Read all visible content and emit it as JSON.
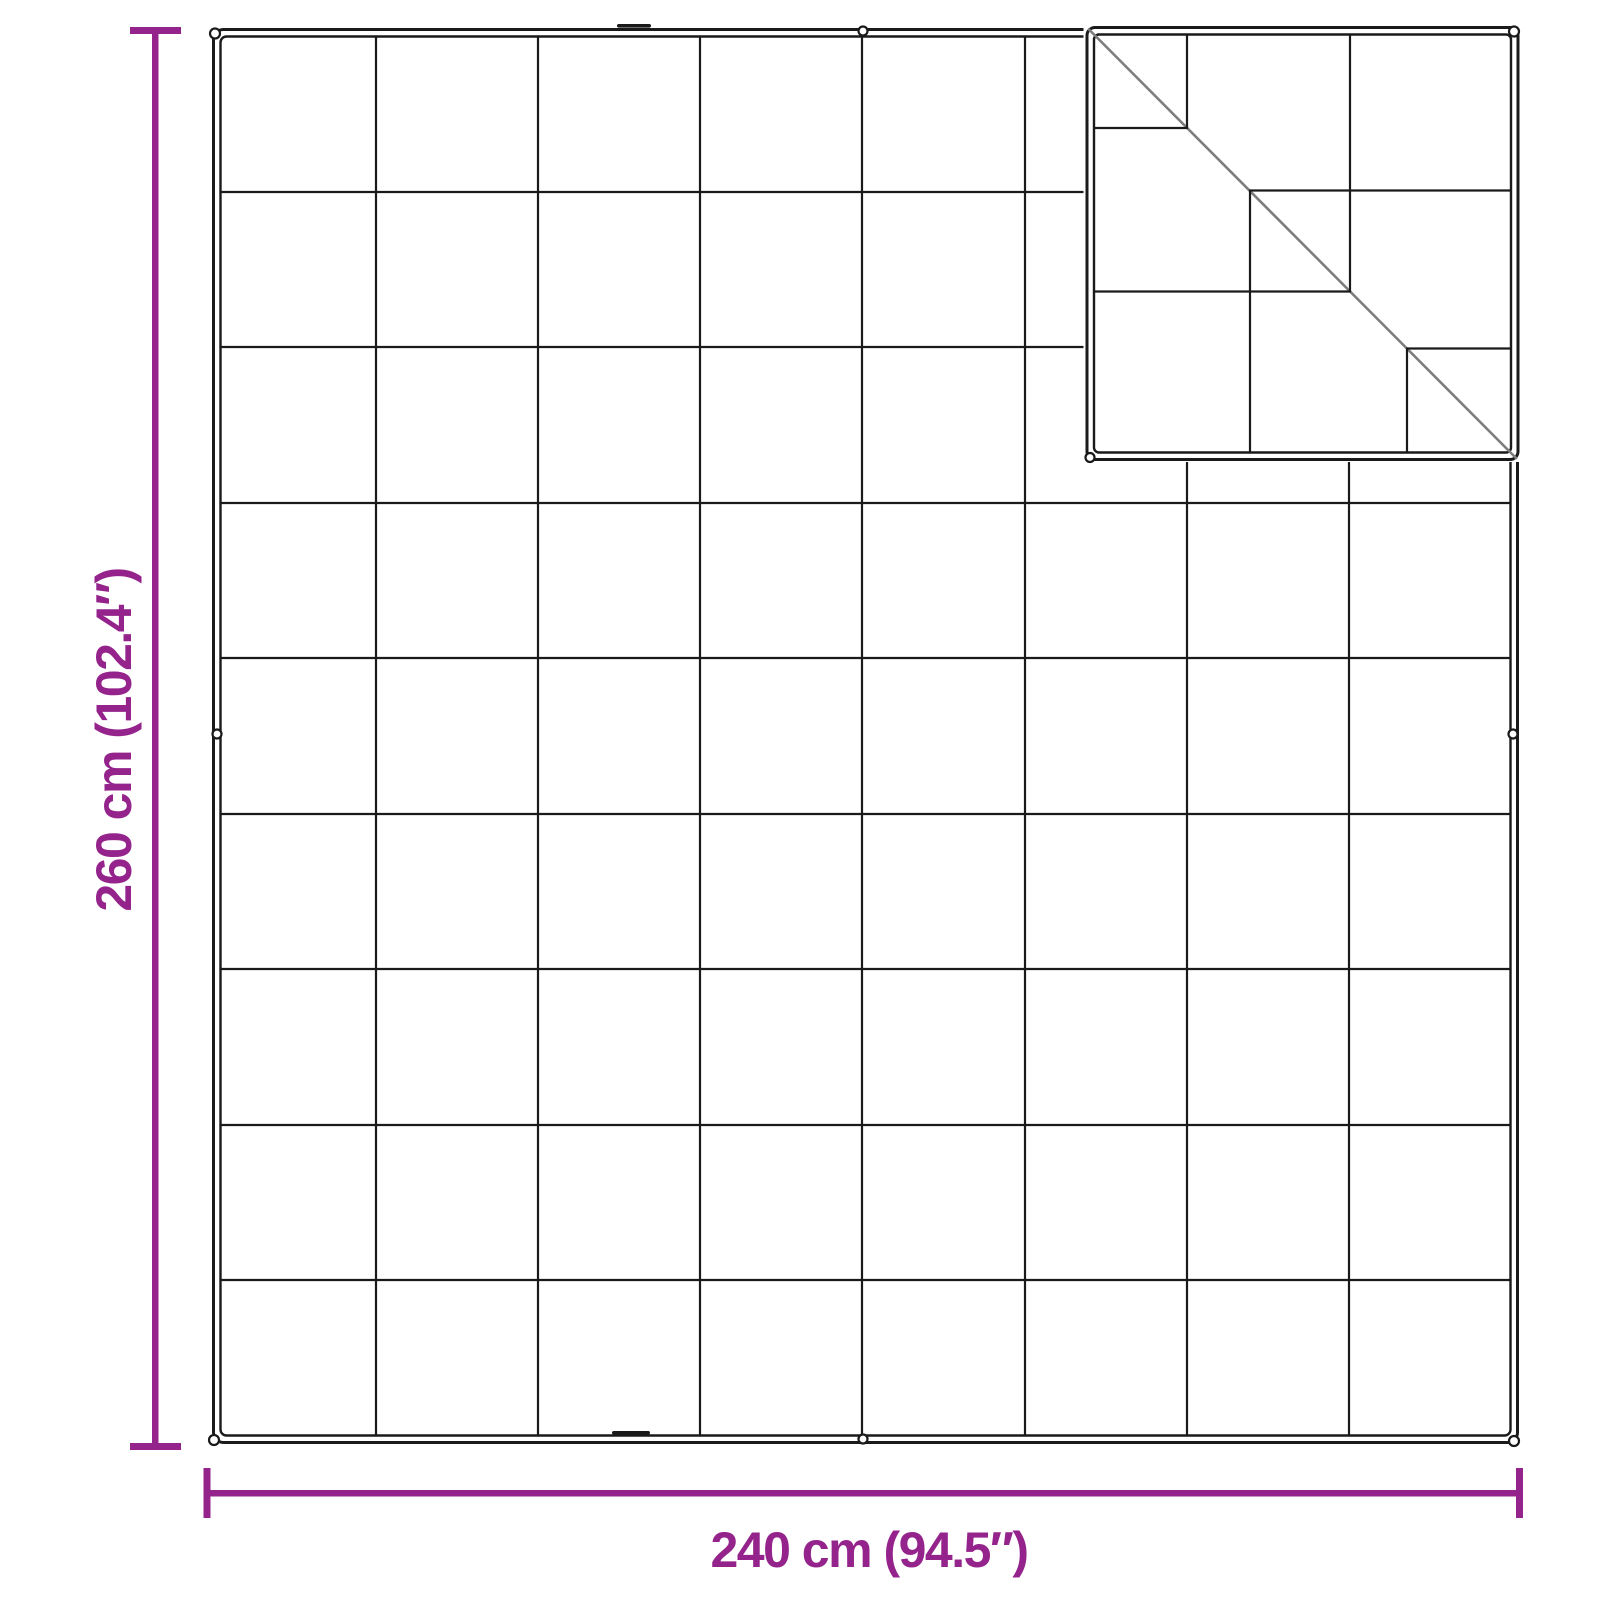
{
  "diagram": {
    "description": "Top view of a quilted blanket with stitched square grid, eyelets on edges, and the top-right corner folded over showing the mirrored quilting of the reverse side",
    "height_dimension": {
      "label": "260 cm (102.4″)",
      "value_cm": 260,
      "value_in": 102.4,
      "orientation": "vertical-left"
    },
    "width_dimension": {
      "label": "240 cm (94.5″)",
      "value_cm": 240,
      "value_in": 94.5,
      "orientation": "horizontal-bottom"
    },
    "grid": {
      "columns": 8,
      "rows": 9
    },
    "folded_corner": {
      "position": "top-right",
      "has_diagonal_fold_line": true
    },
    "colors": {
      "dimension_accent": "#94248C",
      "outline_ink": "#1a1a1a",
      "fold_line": "#7d7d7d",
      "background": "#ffffff"
    }
  }
}
